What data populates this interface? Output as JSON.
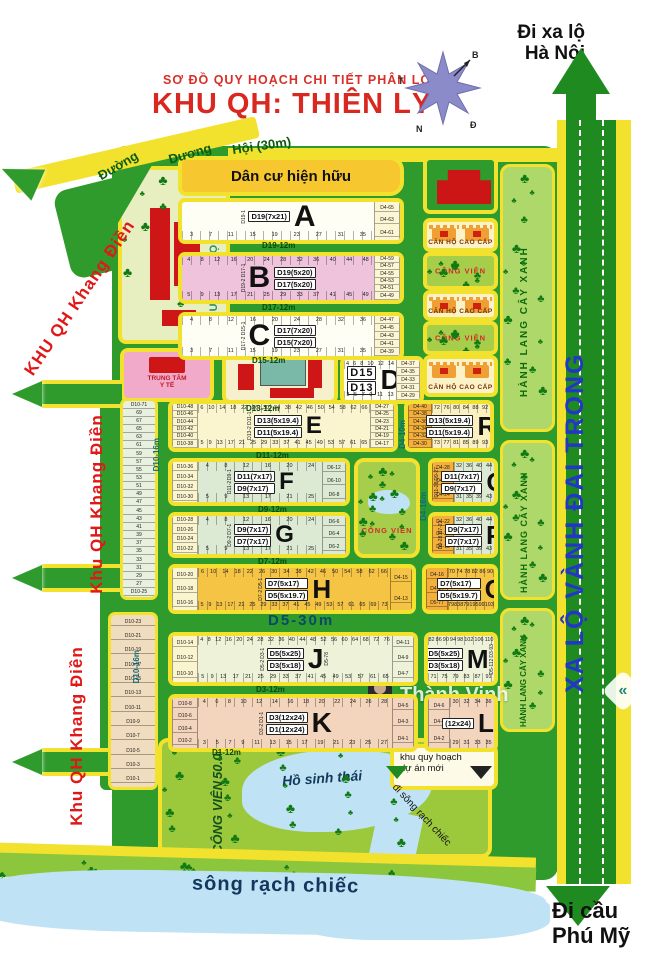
{
  "header": {
    "subtitle": "SƠ  ĐỒ QUY HOẠCH CHI TIẾT PHÂN LÔ",
    "title": "KHU QH: THIÊN LÝ"
  },
  "compass": {
    "west": "T",
    "north": "B",
    "south": "N",
    "east": "Đ"
  },
  "directions": {
    "hanoi_line1": "Đi xa lộ",
    "hanoi_line2": "Hà Nội",
    "phumy_line1": "Đi cầu",
    "phumy_line2": "Phú Mỹ"
  },
  "top_road": {
    "w1": "Đường",
    "w2": "Dương",
    "w3": "Hội (30m)"
  },
  "edge_labels": {
    "khang_dien_1": "KHU QH Khang Điền",
    "khang_dien_2": "Khu QH Khang Điền",
    "khang_dien_3": "Khu QH Khang Điền",
    "ring_road": "XA LỘ VÀNH ĐAI TRONG",
    "green_corridor": "HÀNH LANG CÂY XANH"
  },
  "areas": {
    "existing_residential": "Dân cư hiện hữu",
    "school": "TRƯỜNG HỌC",
    "medical_line1": "TRUNG TÂM",
    "medical_line2": "Y TẾ",
    "big_park_line1": "CÔNG VIÊN",
    "big_park_line2": "50.000m2",
    "eco_lake": "Hồ sinh thái",
    "river": "sông rạch chiếc",
    "new_project_line1": "khu quy hoạch",
    "new_project_line2": "dự án mới",
    "to_river_note": "đi sông rạch chiếc",
    "center_park": "CÔNG VIÊN"
  },
  "watermark": {
    "text": "Thành Vinh"
  },
  "facility_column": [
    {
      "kind": "redbldg",
      "y": 156,
      "h": 58
    },
    {
      "kind": "apt",
      "y": 218,
      "h": 34,
      "label": "CĂN HỘ CAO CẤP"
    },
    {
      "kind": "park",
      "y": 252,
      "h": 38,
      "label": "CÔNG VIÊN"
    },
    {
      "kind": "apt",
      "y": 290,
      "h": 31,
      "label": "CĂN HỘ CAO CẤP"
    },
    {
      "kind": "park",
      "y": 321,
      "h": 34,
      "label": "CÔNG VIÊN"
    },
    {
      "kind": "apt",
      "y": 355,
      "h": 42,
      "label": "CĂN HỘ CAO CẤP"
    }
  ],
  "road_labels": [
    {
      "text": "D19-12m",
      "x": 262,
      "y": 241,
      "cls": "rl"
    },
    {
      "text": "D17-12m",
      "x": 262,
      "y": 303,
      "cls": "rl"
    },
    {
      "text": "D15-12m",
      "x": 252,
      "y": 356,
      "cls": "rl"
    },
    {
      "text": "D13-12m",
      "x": 246,
      "y": 404,
      "cls": "rl"
    },
    {
      "text": "D11-12m",
      "x": 256,
      "y": 451,
      "cls": "rl"
    },
    {
      "text": "D9-12m",
      "x": 258,
      "y": 505,
      "cls": "rl"
    },
    {
      "text": "D7-12m",
      "x": 258,
      "y": 557,
      "cls": "rl"
    },
    {
      "text": "D5-30m",
      "x": 268,
      "y": 612,
      "cls": "rl-big"
    },
    {
      "text": "D3-12m",
      "x": 256,
      "y": 685,
      "cls": "rl"
    },
    {
      "text": "D1-12m",
      "x": 212,
      "y": 748,
      "cls": "rl"
    },
    {
      "text": "D10-16m",
      "x": 152,
      "y": 438,
      "cls": "rl-vert"
    },
    {
      "text": "D10-16m",
      "x": 132,
      "y": 650,
      "cls": "rl-vert"
    },
    {
      "text": "D4-10m",
      "x": 398,
      "y": 420,
      "cls": "rl-vert"
    },
    {
      "text": "D4-16m",
      "x": 419,
      "y": 492,
      "cls": "rl-vert"
    }
  ],
  "plots": [
    {
      "id": "A",
      "x": 178,
      "y": 198,
      "w": 226,
      "h": 46,
      "fill": "#fffef4",
      "letter": "A",
      "lsize": 30,
      "chips": [
        "D19(7x21)"
      ],
      "leftEdge": [
        "D19-1"
      ],
      "botNums": [
        3,
        7,
        11,
        15,
        19,
        23,
        27,
        31,
        35
      ],
      "rightCol": {
        "w": 26,
        "fill": "#fdf6d4",
        "items": [
          "D4-65",
          "D4-63",
          "D4-61"
        ]
      }
    },
    {
      "id": "B",
      "x": 178,
      "y": 252,
      "w": 226,
      "h": 52,
      "fill": "#efc3db",
      "letter": "B",
      "lsize": 30,
      "letterFirst": true,
      "chips": [
        "D19(5x20)",
        "D17(5x20)"
      ],
      "leftEdge": [
        "D19-2",
        "D17-1"
      ],
      "topNums": [
        4,
        8,
        12,
        16,
        20,
        24,
        28,
        32,
        36,
        40,
        44,
        48
      ],
      "botNums": [
        5,
        9,
        13,
        17,
        21,
        25,
        29,
        33,
        37,
        41,
        45,
        49
      ],
      "rightCol": {
        "w": 26,
        "fill": "#fdf6d4",
        "items": [
          "D4-59",
          "D4-57",
          "D4-55",
          "D4-53",
          "D4-51",
          "D4-49"
        ]
      }
    },
    {
      "id": "C",
      "x": 178,
      "y": 312,
      "w": 226,
      "h": 48,
      "fill": "#fffef4",
      "letter": "C",
      "lsize": 30,
      "letterFirst": true,
      "chips": [
        "D17(7x20)",
        "D15(7x20)"
      ],
      "leftEdge": [
        "D17-2",
        "D15-1"
      ],
      "topNums": [
        4,
        8,
        12,
        16,
        20,
        24,
        28,
        32,
        36
      ],
      "botNums": [
        3,
        7,
        11,
        15,
        19,
        23,
        27,
        31,
        35
      ],
      "rightCol": {
        "w": 26,
        "fill": "#fdf6d4",
        "items": [
          "D4-47",
          "D4-45",
          "D4-43",
          "D4-41",
          "D4-39"
        ]
      }
    },
    {
      "id": "D",
      "x": 340,
      "y": 356,
      "w": 84,
      "h": 48,
      "fill": "#fffef4",
      "letter": "D",
      "lsize": 28,
      "chipBig": true,
      "chips": [
        "D15",
        "D13"
      ],
      "leftEdge": [
        "D15-2",
        "D13-1"
      ],
      "topNums": [
        4,
        6,
        8,
        10,
        12,
        14
      ],
      "botNums": [
        3,
        5,
        7,
        9,
        11,
        13
      ],
      "rightCol": {
        "w": 24,
        "fill": "#fdf6d4",
        "items": [
          "D4-37",
          "D4-35",
          "D4-33",
          "D4-31",
          "D4-29"
        ]
      }
    },
    {
      "id": "E",
      "x": 168,
      "y": 400,
      "w": 230,
      "h": 52,
      "fill": "#fbf5cf",
      "letter": "E",
      "lsize": 24,
      "chips": [
        "D13(5x19.4)",
        "D11(5x19.4)"
      ],
      "leftEdge": [
        "D13-2",
        "D11-1"
      ],
      "topNums": [
        6,
        10,
        14,
        18,
        22,
        26,
        30,
        34,
        38,
        42,
        46,
        50,
        54,
        58,
        62,
        66
      ],
      "botNums": [
        5,
        9,
        13,
        17,
        21,
        25,
        29,
        33,
        37,
        41,
        45,
        49,
        53,
        57,
        61,
        65
      ],
      "leftCol": {
        "w": 26,
        "fill": "#fbf5cf",
        "items": [
          "D10-48",
          "D10-46",
          "D10-44",
          "D10-42",
          "D10-40",
          "D10-38"
        ]
      },
      "rightCol": {
        "w": 24,
        "fill": "#fbf5cf",
        "items": [
          "D4-27",
          "D4-25",
          "D4-23",
          "D4-21",
          "D4-19",
          "D4-17"
        ]
      }
    },
    {
      "id": "R",
      "x": 404,
      "y": 400,
      "w": 90,
      "h": 52,
      "fill": "#fbf0c0",
      "letter": "R",
      "lsize": 26,
      "chips": [
        "D13(5x19.4)",
        "D11(5x19.4)"
      ],
      "topNums": [
        72,
        76,
        80,
        84,
        88,
        92
      ],
      "botNums": [
        73,
        77,
        81,
        85,
        89,
        93
      ],
      "leftCol": {
        "w": 24,
        "fill": "#f5b03c",
        "items": [
          "D4-40",
          "D4-38",
          "D4-36",
          "D4-34",
          "D4-32",
          "D4-30"
        ]
      }
    },
    {
      "id": "F",
      "x": 168,
      "y": 458,
      "w": 182,
      "h": 48,
      "fill": "#dcead4",
      "letter": "F",
      "lsize": 24,
      "chips": [
        "D11(7x17)",
        "D9(7x17)"
      ],
      "leftEdge": [
        "D11-2",
        "D9-1"
      ],
      "topNums": [
        4,
        8,
        12,
        16,
        20,
        24
      ],
      "botNums": [
        5,
        9,
        13,
        17,
        21,
        25
      ],
      "leftCol": {
        "w": 26,
        "fill": "#fbf5cf",
        "items": [
          "D10-36",
          "D10-34",
          "D10-32",
          "D10-30"
        ]
      },
      "rightCol": {
        "w": 24,
        "fill": "#dcead4",
        "items": [
          "D6-12",
          "D6-10",
          "D6-8"
        ]
      }
    },
    {
      "id": "G",
      "x": 168,
      "y": 512,
      "w": 182,
      "h": 46,
      "fill": "#dcead4",
      "letter": "G",
      "lsize": 24,
      "chips": [
        "D9(7x17)",
        "D7(7x17)"
      ],
      "leftEdge": [
        "D9-2",
        "D7-1"
      ],
      "topNums": [
        4,
        8,
        12,
        16,
        20,
        24
      ],
      "botNums": [
        5,
        9,
        13,
        17,
        21,
        25
      ],
      "leftCol": {
        "w": 26,
        "fill": "#fbf5cf",
        "items": [
          "D10-28",
          "D10-26",
          "D10-24",
          "D10-22"
        ]
      },
      "rightCol": {
        "w": 24,
        "fill": "#dcead4",
        "items": [
          "D6-6",
          "D6-4",
          "D6-2"
        ]
      }
    },
    {
      "id": "H",
      "x": 168,
      "y": 564,
      "w": 248,
      "h": 50,
      "fill": "#f6c444",
      "letter": "H",
      "lsize": 26,
      "chips": [
        "D7(5x17)",
        "D5(5x19.7)"
      ],
      "leftEdge": [
        "D7-2",
        "D5-1"
      ],
      "topNums": [
        6,
        10,
        14,
        18,
        22,
        26,
        30,
        34,
        38,
        42,
        46,
        50,
        54,
        58,
        62,
        66
      ],
      "botNums": [
        5,
        9,
        13,
        17,
        21,
        25,
        29,
        33,
        37,
        41,
        45,
        49,
        53,
        57,
        61,
        65,
        69,
        73
      ],
      "leftCol": {
        "w": 26,
        "fill": "#fbf5cf",
        "items": [
          "D10-20",
          "D10-18",
          "D10-16"
        ]
      },
      "rightCol": {
        "w": 22,
        "fill": "#f6c444",
        "items": [
          "D4-15",
          "D4-13"
        ]
      }
    },
    {
      "id": "O",
      "x": 422,
      "y": 564,
      "w": 76,
      "h": 50,
      "fill": "#f6c444",
      "letter": "O",
      "lsize": 26,
      "chips": [
        "D7(5x17)",
        "D5(5x19.7)"
      ],
      "topNums": [
        70,
        74,
        78,
        82,
        86,
        90
      ],
      "botNums": [
        79,
        83,
        87,
        91,
        95,
        99,
        103,
        107
      ],
      "leftCol": {
        "w": 22,
        "fill": "#f5b03c",
        "items": [
          "D4-16",
          "D4-14",
          "D5-77"
        ]
      }
    },
    {
      "id": "Q",
      "x": 428,
      "y": 458,
      "w": 70,
      "h": 48,
      "fill": "#dcead4",
      "letter": "Q",
      "lsize": 26,
      "chips": [
        "D11(7x17)",
        "D9(7x17)"
      ],
      "leftEdge": [
        "D11-28",
        "D9-27"
      ],
      "rightEdge": [
        "D11-46",
        "D9-45"
      ],
      "topNums": [
        32,
        36,
        40,
        44
      ],
      "botNums": [
        31,
        35,
        39,
        43
      ],
      "leftCol": {
        "w": 22,
        "fill": "#f5b03c",
        "items": [
          "D4-28",
          "D4-26",
          "D4-24"
        ]
      }
    },
    {
      "id": "P",
      "x": 428,
      "y": 512,
      "w": 70,
      "h": 46,
      "fill": "#dcead4",
      "letter": "P",
      "lsize": 26,
      "chips": [
        "D9(7x17)",
        "D7(7x17)"
      ],
      "leftEdge": [
        "D9-28",
        "D7-27"
      ],
      "rightEdge": [
        "D9-46",
        "D7-45"
      ],
      "topNums": [
        32,
        36,
        40,
        44
      ],
      "botNums": [
        31,
        35,
        39,
        43
      ],
      "leftCol": {
        "w": 22,
        "fill": "#f5b03c",
        "items": [
          "D4-22",
          "D4-20",
          "D4-18"
        ]
      }
    },
    {
      "id": "J",
      "x": 168,
      "y": 632,
      "w": 250,
      "h": 54,
      "fill": "#edf2d8",
      "letter": "J",
      "lsize": 28,
      "chips": [
        "D5(5x25)",
        "D3(5x18)"
      ],
      "leftEdge": [
        "D5-2",
        "D3-1"
      ],
      "rightEdge": [
        "D5-78"
      ],
      "topNums": [
        4,
        8,
        12,
        16,
        20,
        24,
        28,
        32,
        36,
        40,
        44,
        48,
        52,
        56,
        60,
        64,
        68,
        72,
        76
      ],
      "botNums": [
        5,
        9,
        13,
        17,
        21,
        25,
        29,
        33,
        37,
        41,
        45,
        49,
        53,
        57,
        61,
        65
      ],
      "leftCol": {
        "w": 26,
        "fill": "#fbf5cf",
        "items": [
          "D10-14",
          "D10-12",
          "D10-10"
        ]
      },
      "rightCol": {
        "w": 22,
        "fill": "#edf2d8",
        "items": [
          "D4-11",
          "D4-9",
          "D4-7"
        ]
      }
    },
    {
      "id": "M",
      "x": 424,
      "y": 632,
      "w": 74,
      "h": 54,
      "fill": "#edf2d8",
      "letter": "M",
      "lsize": 26,
      "chips": [
        "D5(5x25)",
        "D3(5x18)"
      ],
      "rightEdge": [
        "D5-112",
        "D3-93"
      ],
      "topNums": [
        82,
        86,
        90,
        94,
        98,
        102,
        106,
        110
      ],
      "botNums": [
        71,
        75,
        79,
        83,
        87,
        91
      ]
    },
    {
      "id": "K",
      "x": 168,
      "y": 694,
      "w": 250,
      "h": 58,
      "fill": "#f3d4bd",
      "letter": "K",
      "lsize": 28,
      "chips": [
        "D3(12x24)",
        "D1(12x24)"
      ],
      "leftEdge": [
        "D3-2",
        "D1-1"
      ],
      "topNums": [
        4,
        6,
        8,
        10,
        12,
        14,
        16,
        18,
        20,
        22,
        24,
        26,
        28
      ],
      "botNums": [
        3,
        5,
        7,
        9,
        11,
        13,
        15,
        17,
        19,
        21,
        23,
        25,
        27
      ],
      "leftCol": {
        "w": 26,
        "fill": "#f3d4bd",
        "items": [
          "D10-8",
          "D10-6",
          "D10-4",
          "D10-2"
        ]
      },
      "rightCol": {
        "w": 22,
        "fill": "#f3d4bd",
        "items": [
          "D4-5",
          "D4-3",
          "D4-1"
        ]
      }
    },
    {
      "id": "L",
      "x": 424,
      "y": 694,
      "w": 74,
      "h": 58,
      "fill": "#f3d4bd",
      "letter": "L",
      "lsize": 26,
      "chips": [
        "(12x24)"
      ],
      "rightEdge": [
        "D3-40"
      ],
      "topNums": [
        30,
        32,
        34,
        36
      ],
      "botNums": [
        29,
        31,
        33,
        35
      ],
      "leftCol": {
        "w": 22,
        "fill": "#f3d4bd",
        "items": [
          "D4-6",
          "D4-4",
          "D4-2"
        ]
      }
    }
  ],
  "left_strips": {
    "upper": {
      "x": 120,
      "y": 398,
      "w": 38,
      "h": 202,
      "fill": "#e8f0e0",
      "items": [
        "D10-71",
        "69",
        "67",
        "65",
        "63",
        "61",
        "59",
        "57",
        "55",
        "53",
        "51",
        "49",
        "47",
        "45",
        "43",
        "41",
        "39",
        "37",
        "35",
        "33",
        "31",
        "29",
        "27",
        "D10-25"
      ]
    },
    "lower": {
      "x": 108,
      "y": 612,
      "w": 50,
      "h": 178,
      "fill": "#f0dcbe",
      "items": [
        "D10-23",
        "D10-21",
        "D10-19",
        "D10-17",
        "D10-15",
        "D10-13",
        "D10-11",
        "D10-9",
        "D10-7",
        "D10-5",
        "D10-3",
        "D10-1"
      ]
    }
  }
}
